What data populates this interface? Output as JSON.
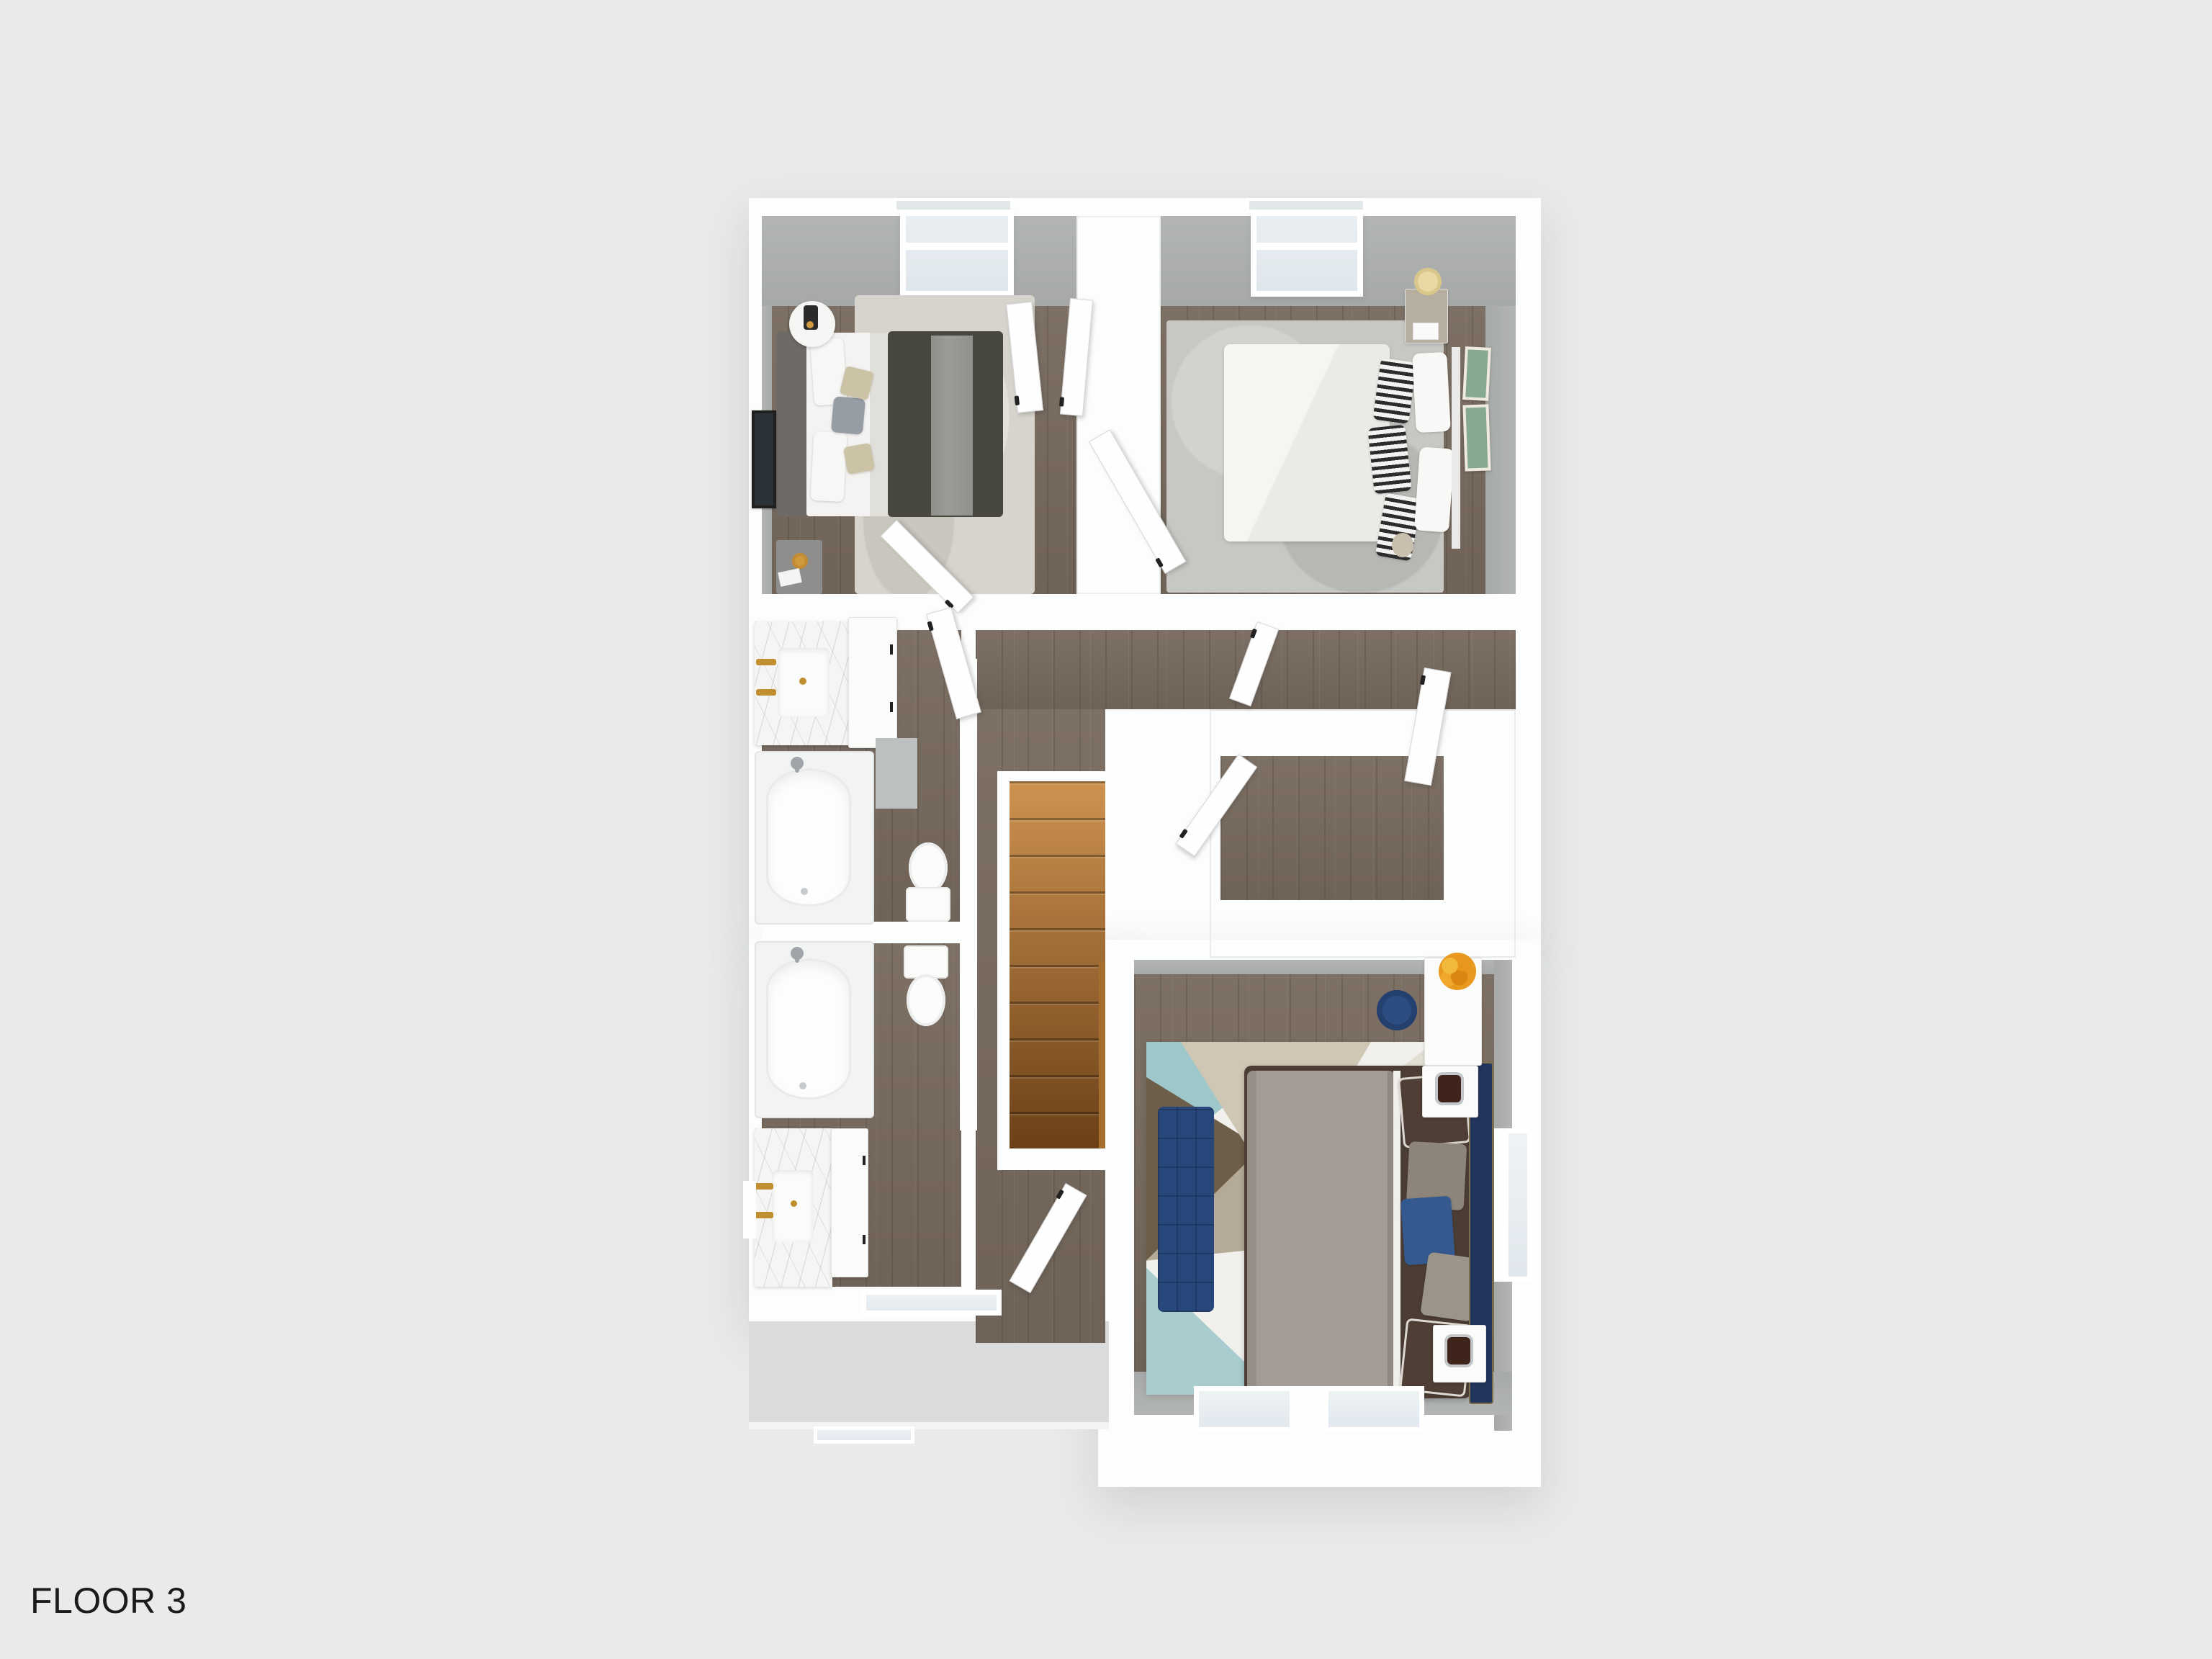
{
  "scene": {
    "background": "#e9eaea"
  },
  "label": {
    "text": "FLOOR 3",
    "color": "#1b1b1d"
  },
  "palette": {
    "bg": "#e9eaea",
    "wall": "#fcfdfd",
    "wallface": "#a6a9a8",
    "roof": "#d9dcdb",
    "wood": "#786a5e",
    "woodline": "rgba(46,34,24,0.16)",
    "stairTop": "#cd9350",
    "stairBottom": "#6b4018",
    "banister": "#a5702f",
    "marble": "#f5f5f3",
    "gold": "#c08f2f",
    "chrome": "#9fa5a8",
    "glass": "#e0e7ec",
    "rugA": "#d6d4cd",
    "rugB": "#c7c7c4",
    "rugM": "#f1f0ec",
    "tealRug": "#9ec7c9",
    "tealRug2": "#a9cdcf",
    "brownRug": "#6d5e49",
    "tanRug": "#cfc6b4",
    "oliveRug": "#b3aa97",
    "navyBench": "#28477a",
    "navyChair": "#2c4d82",
    "navyHead": "#22355c",
    "navyPillow": "#33598f",
    "duvetA": "#47473f",
    "throwA": "#9b9c98",
    "headA": "#6e6a66",
    "duvetM": "#4b3d34",
    "comfM": "#a29c94",
    "pillowBrown": "#4e3e35",
    "sheet": "#f6f5f2",
    "stripeDark": "#2c2c2c",
    "tanPillow": "#ccc3a6",
    "grayPillow": "#969da4",
    "nightB": "#b6ae9f",
    "lampCream": "#ead9a4",
    "lampDark": "#3f241c",
    "artGreen": "#87a98f",
    "flower": "#e6971c",
    "amber": "#d0993e",
    "handle": "#222222",
    "labelc": "#1b1b1d"
  }
}
